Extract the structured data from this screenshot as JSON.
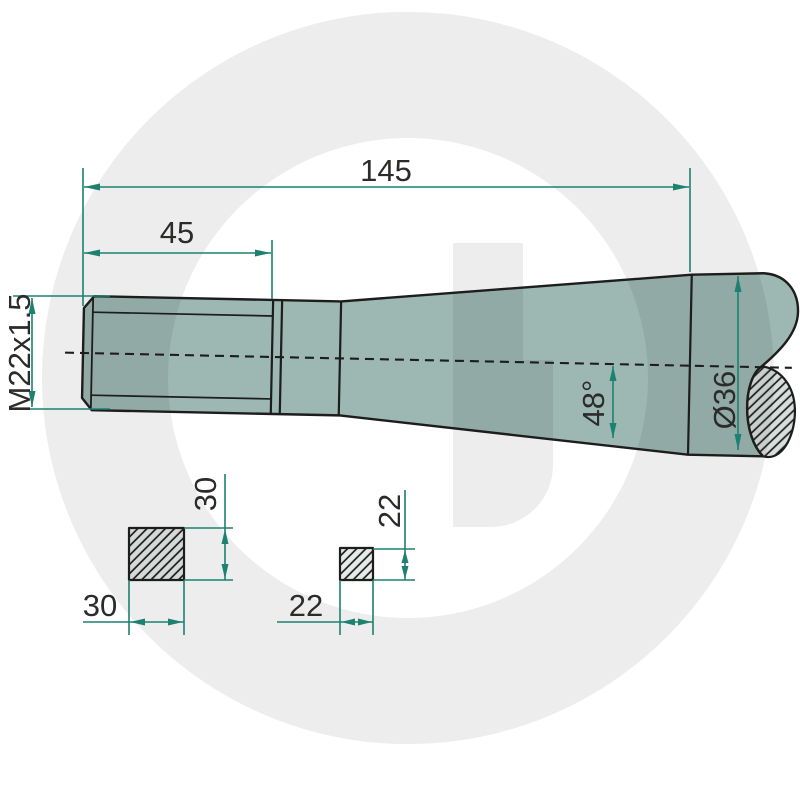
{
  "drawing": {
    "type": "technical-part-drawing",
    "watermark_letter": "G",
    "dimensions": {
      "overall_length": "145",
      "thread_length": "45",
      "thread_spec": "M22x1.5",
      "taper_angle": "48°",
      "shaft_diameter": "Ø36",
      "square_large_height": "30",
      "square_large_width": "30",
      "square_small_height": "22",
      "square_small_width": "22"
    }
  },
  "colors": {
    "bg": "#ffffff",
    "ink": "#2b2b29",
    "outline": "#1d1d1b",
    "dim": "#1d8170",
    "body-fill": "#9db7b3",
    "section-fill": "#d7dfdc",
    "square-fill": "#e6ebe9",
    "watermark": "#ededed"
  }
}
